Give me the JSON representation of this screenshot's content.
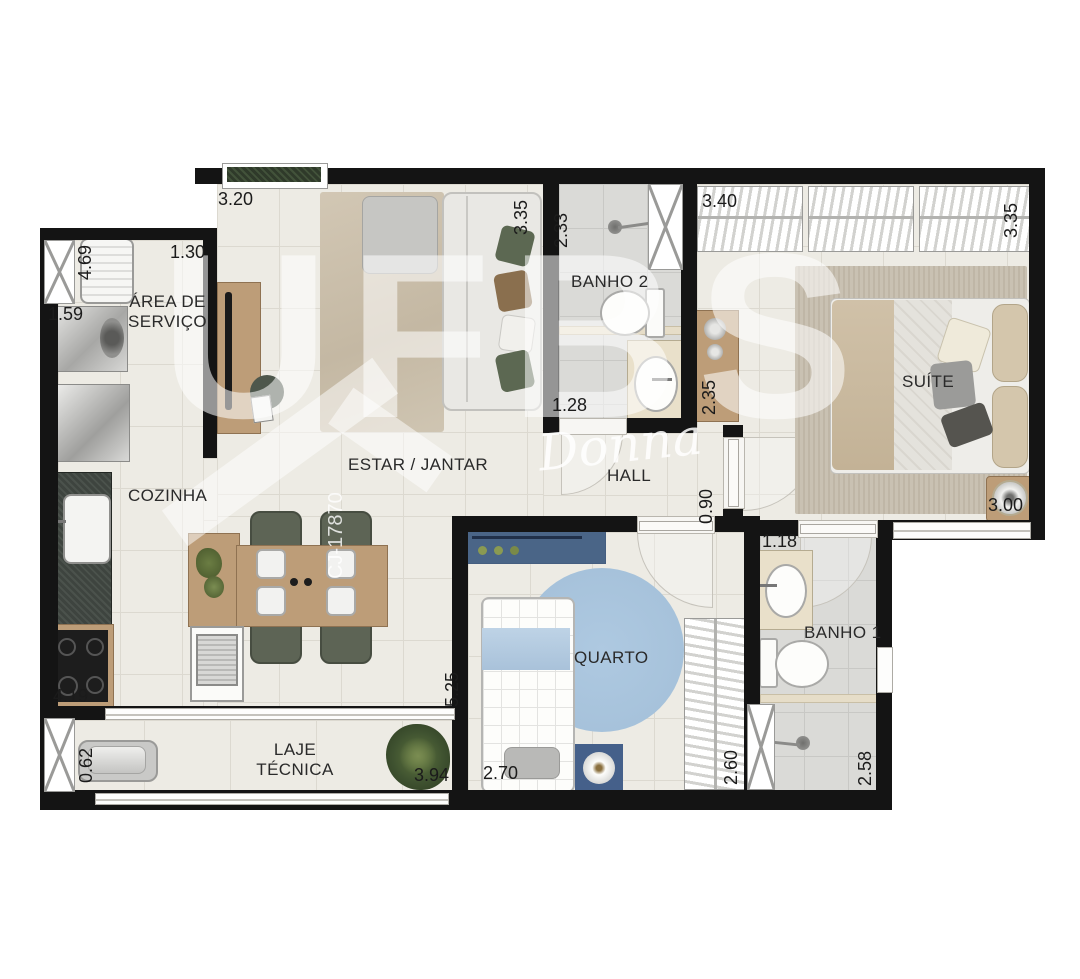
{
  "plan": {
    "rooms": {
      "area_servico": {
        "label_line1": "ÁREA DE",
        "label_line2": "SERVIÇO"
      },
      "cozinha": {
        "label": "COZINHA"
      },
      "estar_jantar": {
        "label": "ESTAR / JANTAR"
      },
      "banho2": {
        "label": "BANHO 2"
      },
      "hall": {
        "label": "HALL"
      },
      "suite": {
        "label": "SUÍTE"
      },
      "quarto": {
        "label": "QUARTO"
      },
      "banho1": {
        "label": "BANHO 1"
      },
      "laje_tecnica": {
        "label_line1": "LAJE",
        "label_line2": "TÉCNICA"
      }
    },
    "measurements": {
      "estar_top": "3.20",
      "servico_top": "1.30",
      "servico_left_wall": "4.69",
      "servico_side": "1.59",
      "estar_right": "3.35",
      "banho2_left": "2.33",
      "banho2_bottom": "1.28",
      "suite_closet_top": "3.40",
      "suite_right": "3.35",
      "suite_dresser": "2.35",
      "hall_right": "0.90",
      "suite_bottom": "3.00",
      "banho1_top": "1.18",
      "banho1_bottom_right": "2.58",
      "quarto_closet_right": "2.60",
      "quarto_bottom": "2.70",
      "cozinha_right": "5.25",
      "cozinha_stove": "4.19",
      "laje_left": "0.62",
      "laje_bottom_right": "3.94"
    },
    "watermark": {
      "script": "Donna",
      "brand": "UFBS",
      "registration": "CJ-17870"
    },
    "colors": {
      "wall": "#141414",
      "floor": "#edebe4",
      "bath_floor": "#dadad7",
      "wood": "#bd9d78",
      "granite": "#3e443f",
      "chair_olive": "#5d6455",
      "rug_beige": "#cdc2b0",
      "rug_blue": "#a9c5de",
      "desk_blue": "#4a6587",
      "bed_blue": "#b4cbdf",
      "watermark": "#ffffff"
    }
  }
}
